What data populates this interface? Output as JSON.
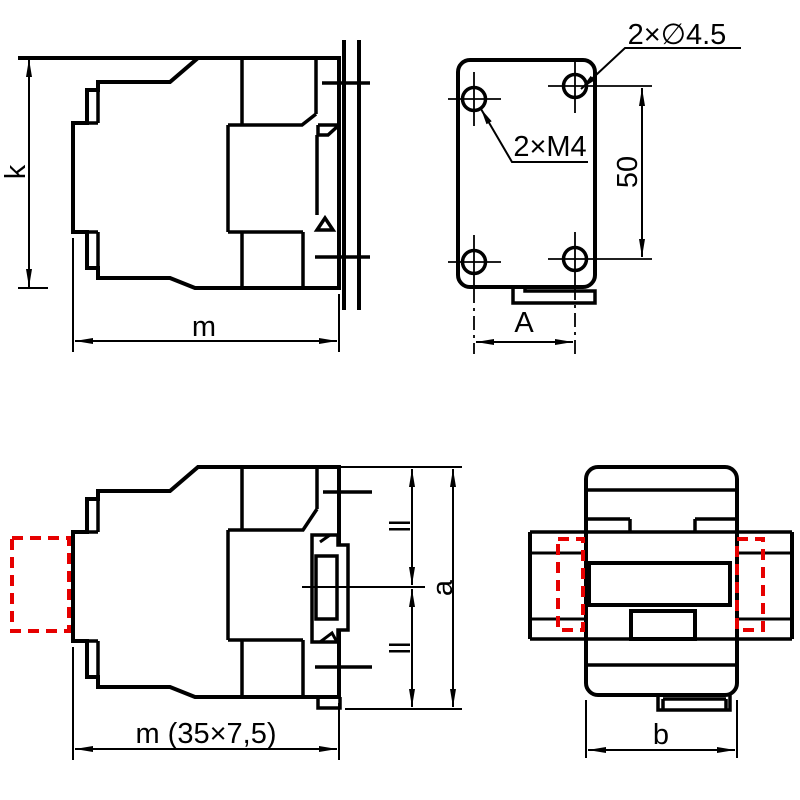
{
  "page": {
    "background": "#ffffff",
    "line_color": "#000000",
    "highlight_color": "#e60000"
  },
  "views": {
    "side_rail": {
      "height_label": "k",
      "width_label": "m"
    },
    "mounting_plate": {
      "hole_callout": "2×∅4.5",
      "thread_callout": "2×M4",
      "pitch_label": "50",
      "width_label": "A"
    },
    "side_released": {
      "upper_half_label": "ll",
      "lower_half_label": "ll",
      "height_label": "a",
      "width_label": "m (35×7,5)"
    },
    "top_view": {
      "width_label": "b"
    }
  }
}
